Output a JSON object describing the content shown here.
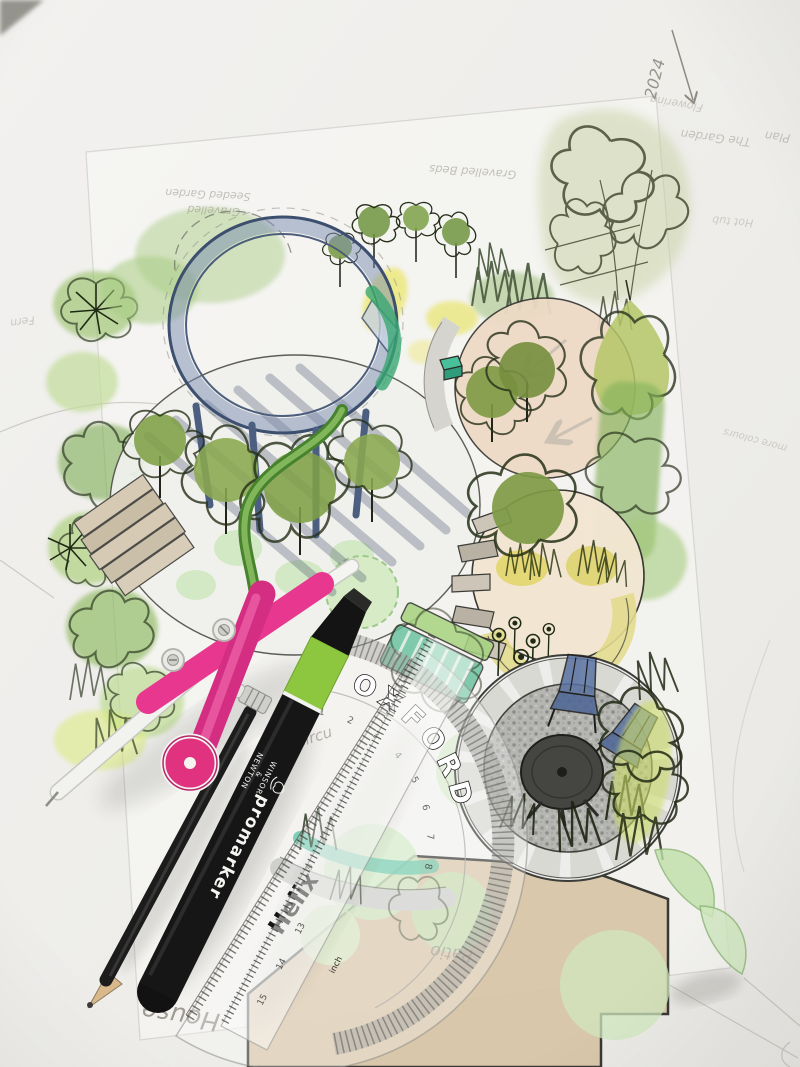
{
  "annotations": {
    "year": "2024",
    "plan": "Plan",
    "garden_title": "The Garden",
    "flowering": "Flowering",
    "gravelled": "Gravelled",
    "seeded_garden": "Seeded Garden",
    "gravelled_beds": "Gravelled Beds",
    "fern": "Fern",
    "hot_tub": "Hot tub",
    "more_colours": "more colours",
    "circular_partial": "Circu",
    "patio": "Patio",
    "house": "House"
  },
  "tools": {
    "marker": {
      "product": "promarker",
      "brand_top": "WINSOR",
      "brand_amp": "&",
      "brand_bottom": "NEWTON"
    },
    "protractor": {
      "brand": "Helix",
      "reg": "®",
      "series": "OXFORD",
      "unit": "inch",
      "ruler_numbers": "15 14 13",
      "scale_numbers": "1 2 3 4 5 6 7 8 9 10"
    }
  },
  "palette": {
    "compass_pink": "#E8378F",
    "marker_band_green": "#8DC63F",
    "foliage_green": "#9CC46E",
    "wash_green": "#CDE8C0",
    "patio_tan": "#D9C6A8",
    "pergola_blue": "#56719F",
    "accent_teal": "#4FBF9A",
    "accent_yellow": "#E6E04A",
    "paper": "#EFEEEC",
    "pencil_gray": "#8F8C85"
  }
}
